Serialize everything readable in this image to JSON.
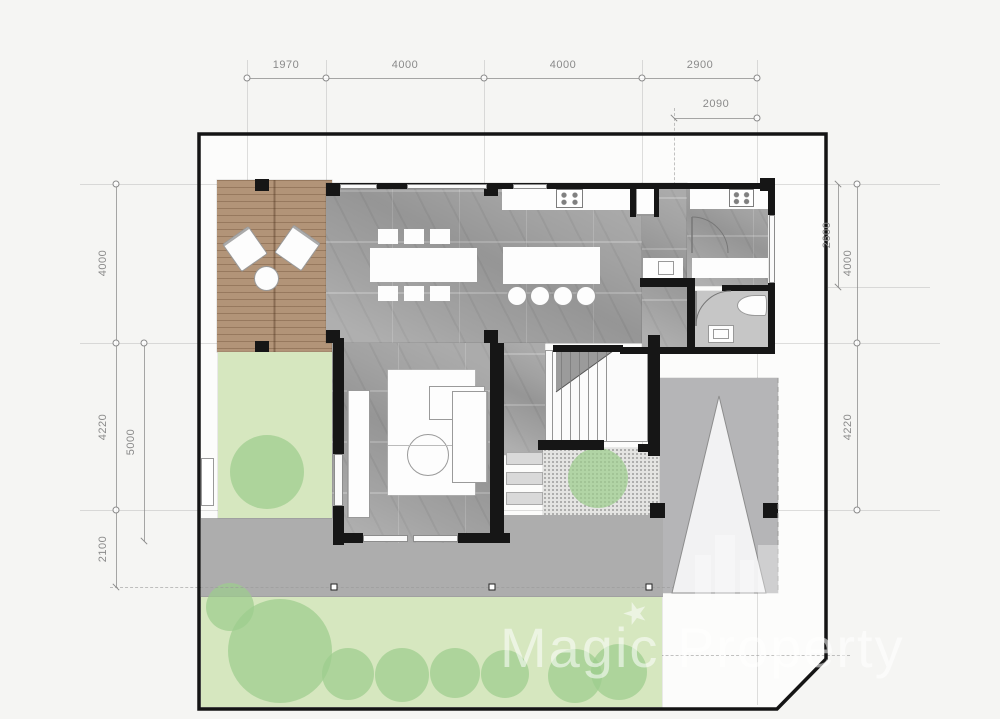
{
  "watermark": {
    "text": "Magic Property",
    "star": "★"
  },
  "dimensions": {
    "top": [
      "1970",
      "4000",
      "4000",
      "2900"
    ],
    "top_secondary": "2090",
    "left": [
      "4000",
      "4220",
      "2100"
    ],
    "left_inner": "5000",
    "right": [
      "2600",
      "4000",
      "4220"
    ]
  },
  "colors": {
    "paper": "#f5f5f3",
    "inner": "#fcfcfb",
    "boundary": "#141414",
    "wall": "#161616",
    "deck": "#b29478",
    "marble": "#a2a2a2",
    "bath_floor": "#c6c6c6",
    "lawn": "#d6e7bf",
    "tree": "#9ccd8e",
    "gravel": "#e4e4e2",
    "walkway": "#adadad",
    "carport": "#b5b5b7",
    "grid": "#9a9a9a",
    "dim": "#8a8a8a",
    "furniture_outline": "#999999",
    "watermark": "rgba(255,255,255,0.55)"
  }
}
